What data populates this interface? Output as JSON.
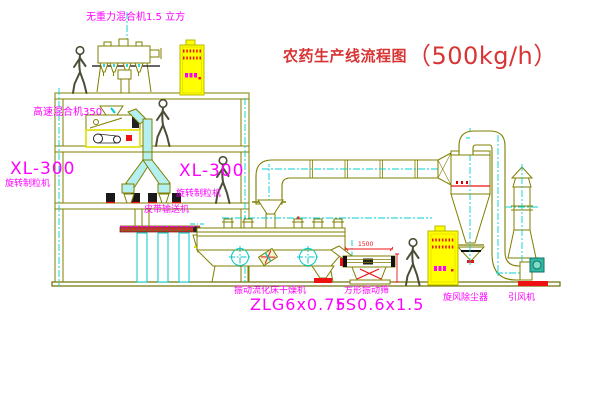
{
  "title": {
    "text": "农药生产线流程图",
    "capacity": "（500kg/h）"
  },
  "labels": {
    "gravity_free_mixer": "无重力混合机1.5 立方",
    "high_speed_mixer": "高速混合机350",
    "granulator_left_model": "XL-300",
    "granulator_left_name": "旋转制粒机",
    "granulator_right_model": "XL-300",
    "granulator_right_name": "旋转制粒机",
    "belt_conveyor": "皮带输送机",
    "dryer_name": "振动流化床干燥机",
    "dryer_model": "ZLG6x0.75",
    "sieve_name": "方形振动筛",
    "sieve_model": "FS0.6x1.5",
    "cyclone": "旋风除尘器",
    "fan": "引风机"
  },
  "dimensions": {
    "sieve_length": "1500"
  },
  "colors": {
    "drawing_line": "#7f7f00",
    "centerline": "#00cccc",
    "label": "#ff00ff",
    "title": "#d83434",
    "accent": "#ee1111",
    "cabinet_fill": "#ffff00"
  }
}
